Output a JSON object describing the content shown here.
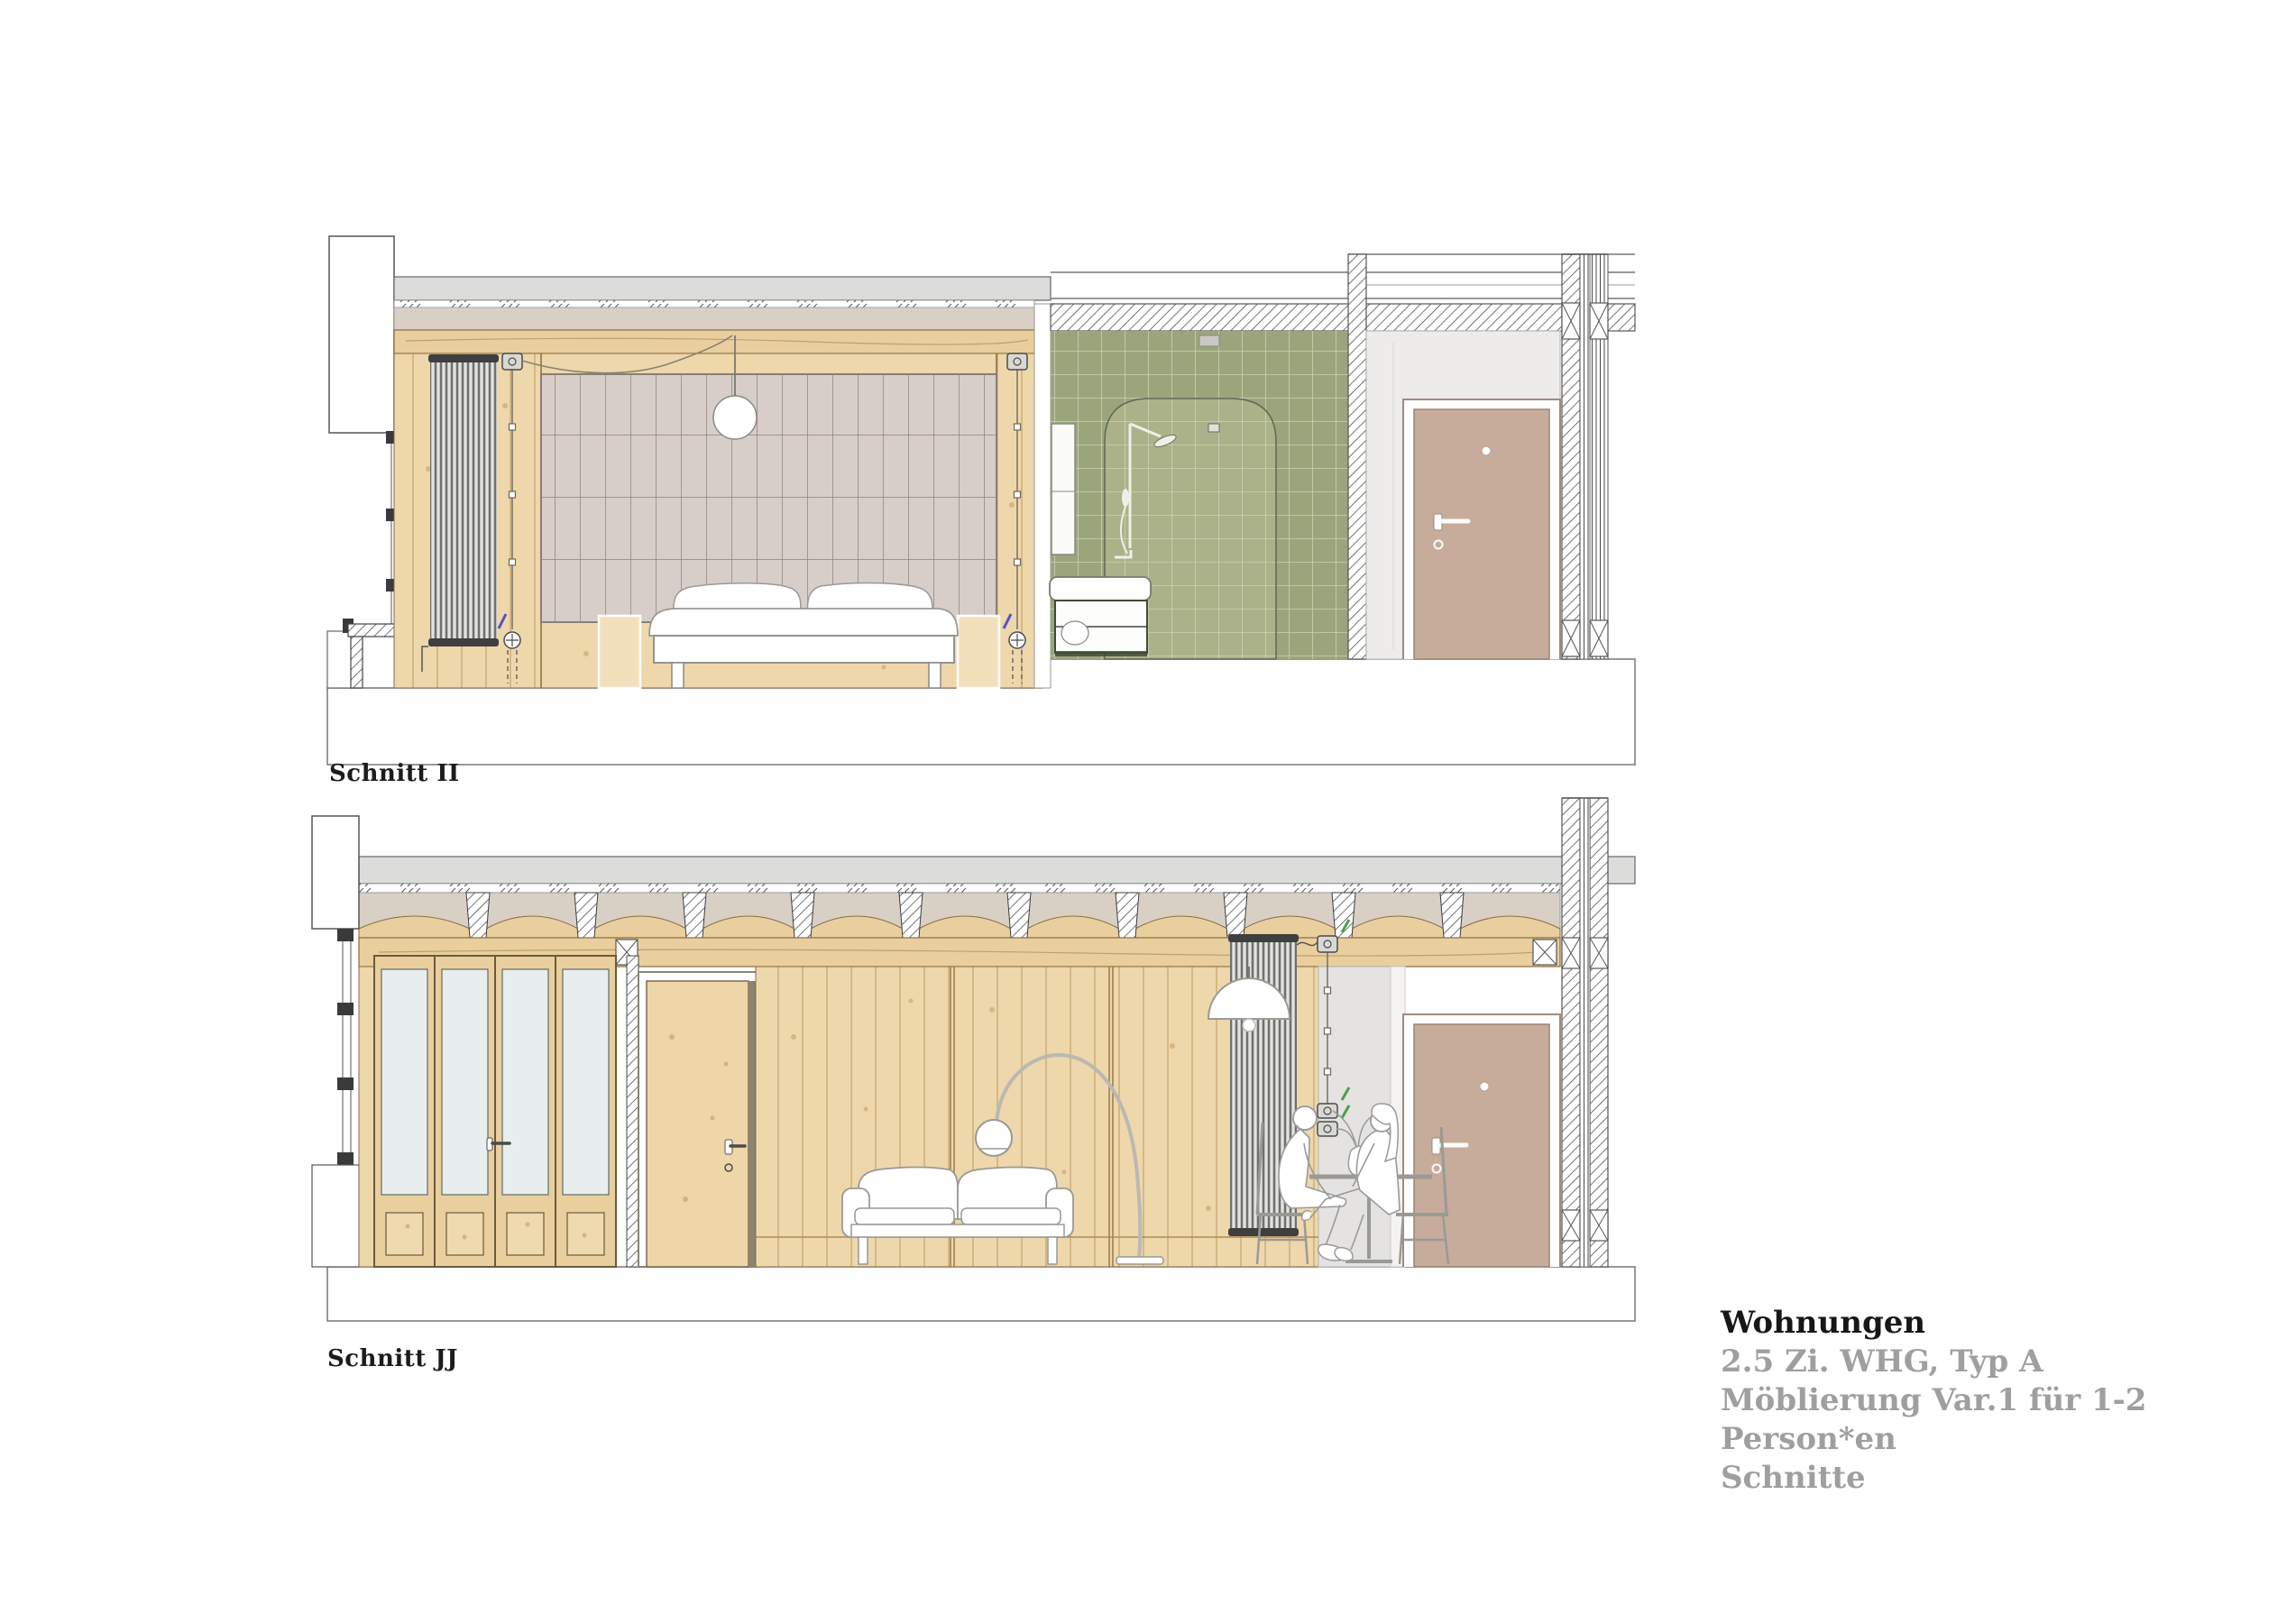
{
  "document": {
    "type": "architectural-section-sheet",
    "background": "#ffffff"
  },
  "sections": [
    {
      "id": "schnitt-ii",
      "label": "Schnitt II"
    },
    {
      "id": "schnitt-jj",
      "label": "Schnitt JJ"
    }
  ],
  "title_block": {
    "title": "Wohnungen",
    "subtitle1": "2.5 Zi. WHG, Typ A",
    "subtitle2": "Möblierung Var.1 für 1-2 Person*en",
    "subtitle3": "Schnitte"
  },
  "colors": {
    "wood_wall": "#eed7ab",
    "wood_frame": "#e9cf9e",
    "tile_green": "#9aa57c",
    "tile_green_light": "#abb289",
    "door_rose": "#c7ac9c",
    "curtain_mauve": "#d8cec9",
    "slab_grey": "#dcdcdb",
    "screed_beige": "#d9d0c5",
    "text_grey": "#9f9f9f",
    "accent_blue": "#5a52c0",
    "accent_green": "#4aa04a"
  }
}
